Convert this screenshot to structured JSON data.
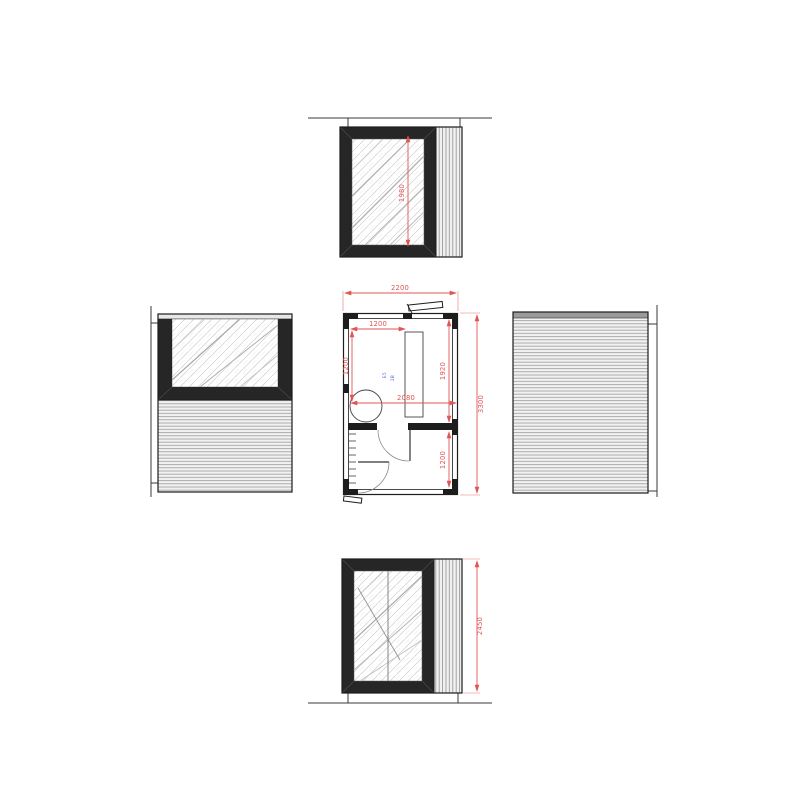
{
  "colors": {
    "dimension_red": "#e05555",
    "annotation_blue": "#4f6fd6",
    "frame_dark": "#262626"
  },
  "plan": {
    "dims": {
      "width": "2200",
      "total_depth": "3300",
      "upper_room_depth": "1920",
      "lower_room_depth": "1200",
      "counter_inset": "1200",
      "left_inset": "1200",
      "mid_width": "2080"
    },
    "annotation": {
      "line1": "E5",
      "line2": "2B"
    }
  },
  "top_elevation": {
    "dims": {
      "glass_height": "1980"
    }
  },
  "bottom_elevation": {
    "dims": {
      "height": "2450"
    }
  }
}
